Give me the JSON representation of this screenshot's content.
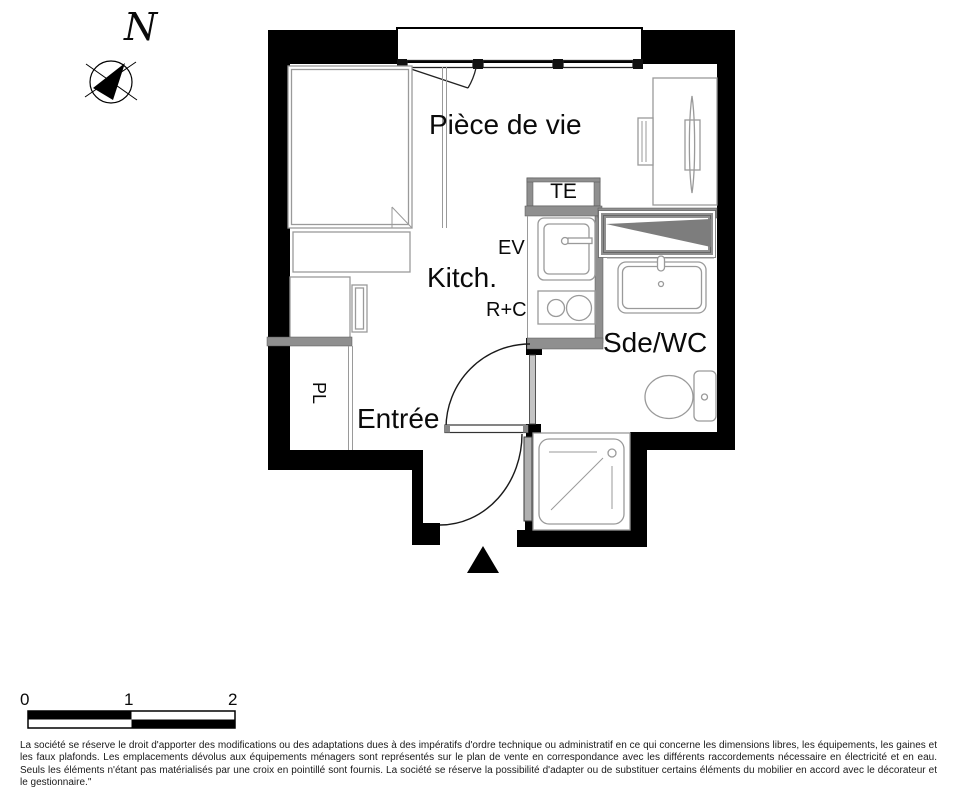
{
  "compass": {
    "north_label": "N"
  },
  "rooms": {
    "living": "Pièce de vie",
    "kitchen": "Kitch.",
    "entry": "Entrée",
    "shower_wc": "Sde/WC",
    "closet": "PL"
  },
  "equipment_labels": {
    "electrical_panel": "TE",
    "sink": "EV",
    "fridge_cooktop": "R+C"
  },
  "scale_bar": {
    "ticks": [
      "0",
      "1",
      "2"
    ]
  },
  "legal_notice": "La société se réserve le droit d'apporter des modifications ou des adaptations dues à des impératifs d'ordre technique ou administratif en ce qui concerne les dimensions libres, les équipements, les gaines et les faux plafonds. Les emplacements dévolus aux équipements ménagers sont représentés sur le plan de vente en correspondance avec les différents raccordements nécessaire en électricité et en eau. Seuls les éléments n'étant pas matérialisés par une croix en pointillé sont fournis. La société se réserve la possibilité d'adapter ou de substituer certains éléments du mobilier en accord avec le décorateur et le gestionnaire.\"",
  "colors": {
    "wall": "#000000",
    "partition": "#8f8f8f",
    "furniture_line": "#9a9a9a",
    "label_text": "#0a0a0a"
  }
}
